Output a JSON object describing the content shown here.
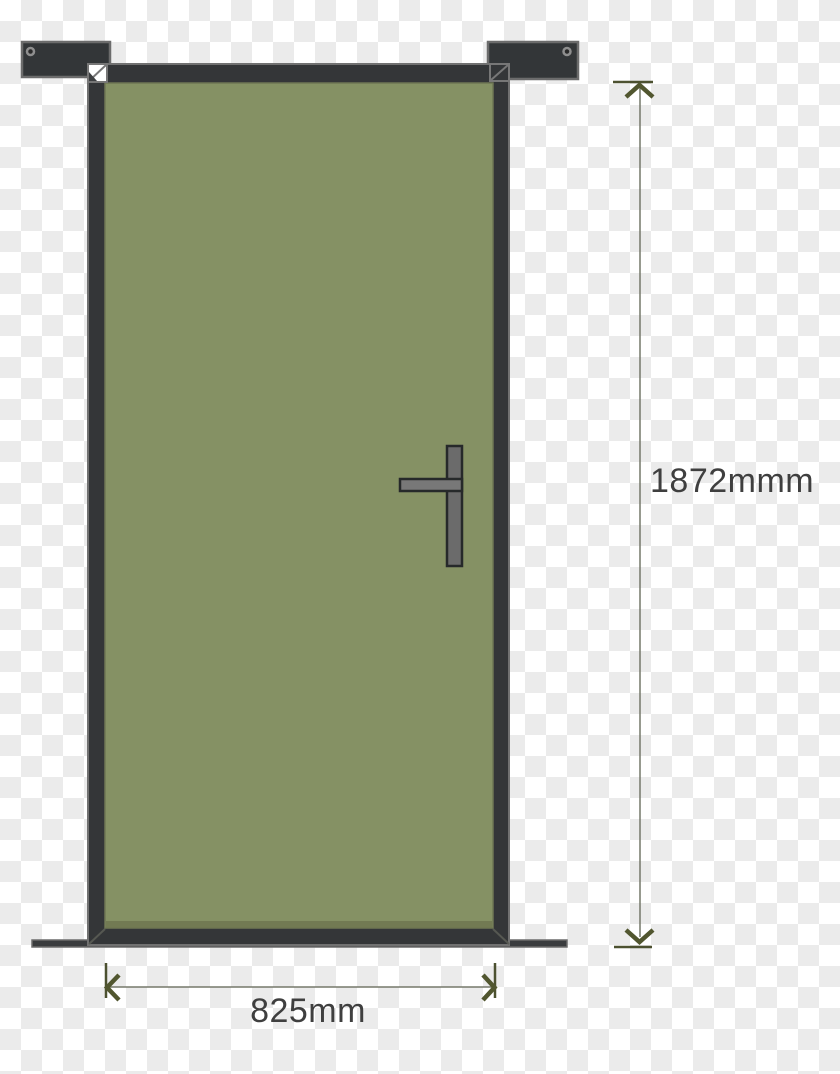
{
  "diagram": {
    "type": "door-dimension-diagram",
    "labels": {
      "height": "1872mmm",
      "width": "825mm"
    },
    "door": {
      "panel_color": "#859164",
      "panel_shadow_color": "#6e7550",
      "frame_color": "#343638",
      "frame_outline_color": "#717171",
      "bracket_color": "#333638",
      "bracket_outline_color": "#6c6c6c",
      "sill_color": "#3a3c3e",
      "handle_plate_color": "#6b6b6b",
      "handle_lever_color": "#787878",
      "handle_outline_color": "#26292a"
    },
    "dimension_style": {
      "line_color": "#75786a",
      "arrow_color": "#51562f",
      "cap_color": "#4c5130",
      "text_color": "#3f3f3f"
    },
    "background": {
      "checker_light": "#ffffff",
      "checker_dark": "#ebebeb",
      "cell_px": 21
    }
  }
}
